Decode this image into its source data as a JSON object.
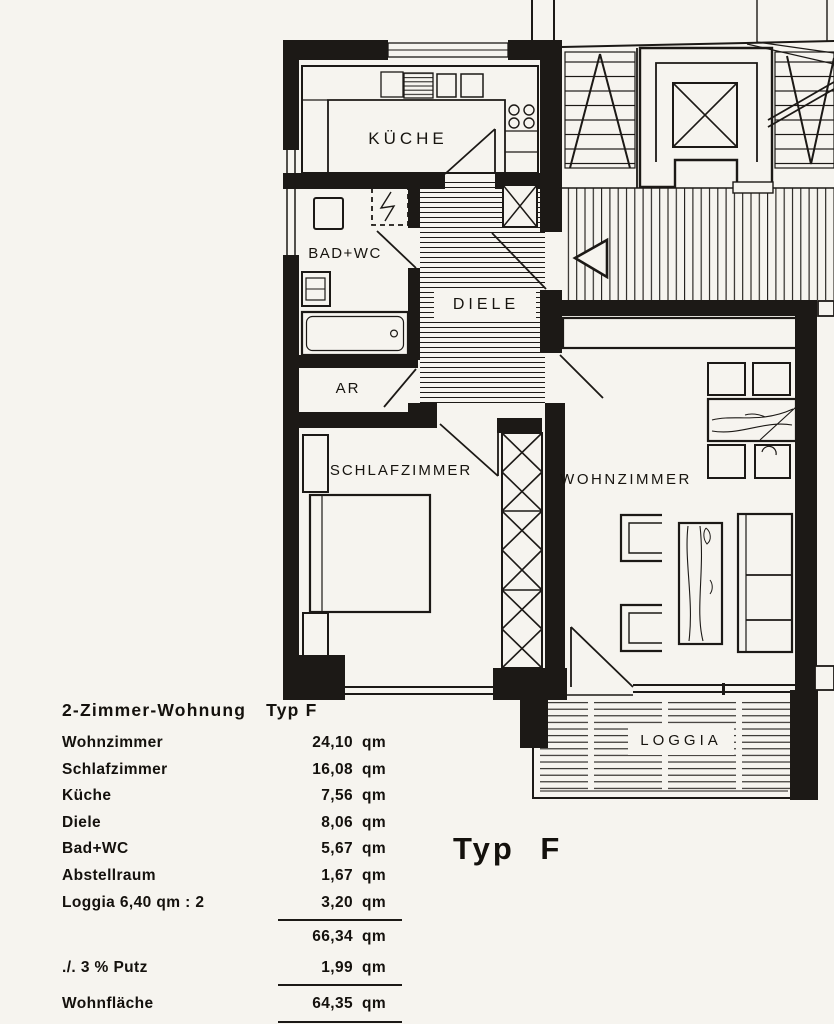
{
  "document": {
    "type_label": "Typ F"
  },
  "rooms": {
    "kueche": "KÜCHE",
    "bad_wc": "BAD+WC",
    "diele": "DIELE",
    "ar": "AR",
    "schlafzimmer": "SCHLAFZIMMER",
    "wohnzimmer": "WOHNZIMMER",
    "loggia": "LOGGIA"
  },
  "area_table": {
    "title_left": "2-Zimmer-Wohnung",
    "title_right": "Typ F",
    "rows": [
      {
        "label": "Wohnzimmer",
        "value": "24,10",
        "unit": "qm"
      },
      {
        "label": "Schlafzimmer",
        "value": "16,08",
        "unit": "qm"
      },
      {
        "label": "Küche",
        "value": "7,56",
        "unit": "qm"
      },
      {
        "label": "Diele",
        "value": "8,06",
        "unit": "qm"
      },
      {
        "label": "Bad+WC",
        "value": "5,67",
        "unit": "qm"
      },
      {
        "label": "Abstellraum",
        "value": "1,67",
        "unit": "qm"
      },
      {
        "label": "Loggia 6,40 qm : 2",
        "value": "3,20",
        "unit": "qm"
      }
    ],
    "subtotal": {
      "label": "",
      "value": "66,34",
      "unit": "qm"
    },
    "deduction": {
      "label": "./. 3 % Putz",
      "value": "1,99",
      "unit": "qm"
    },
    "total": {
      "label": "Wohnfläche",
      "value": "64,35",
      "unit": "qm"
    }
  },
  "colors": {
    "ink": "#1c1916",
    "paper": "#f6f4ef"
  }
}
